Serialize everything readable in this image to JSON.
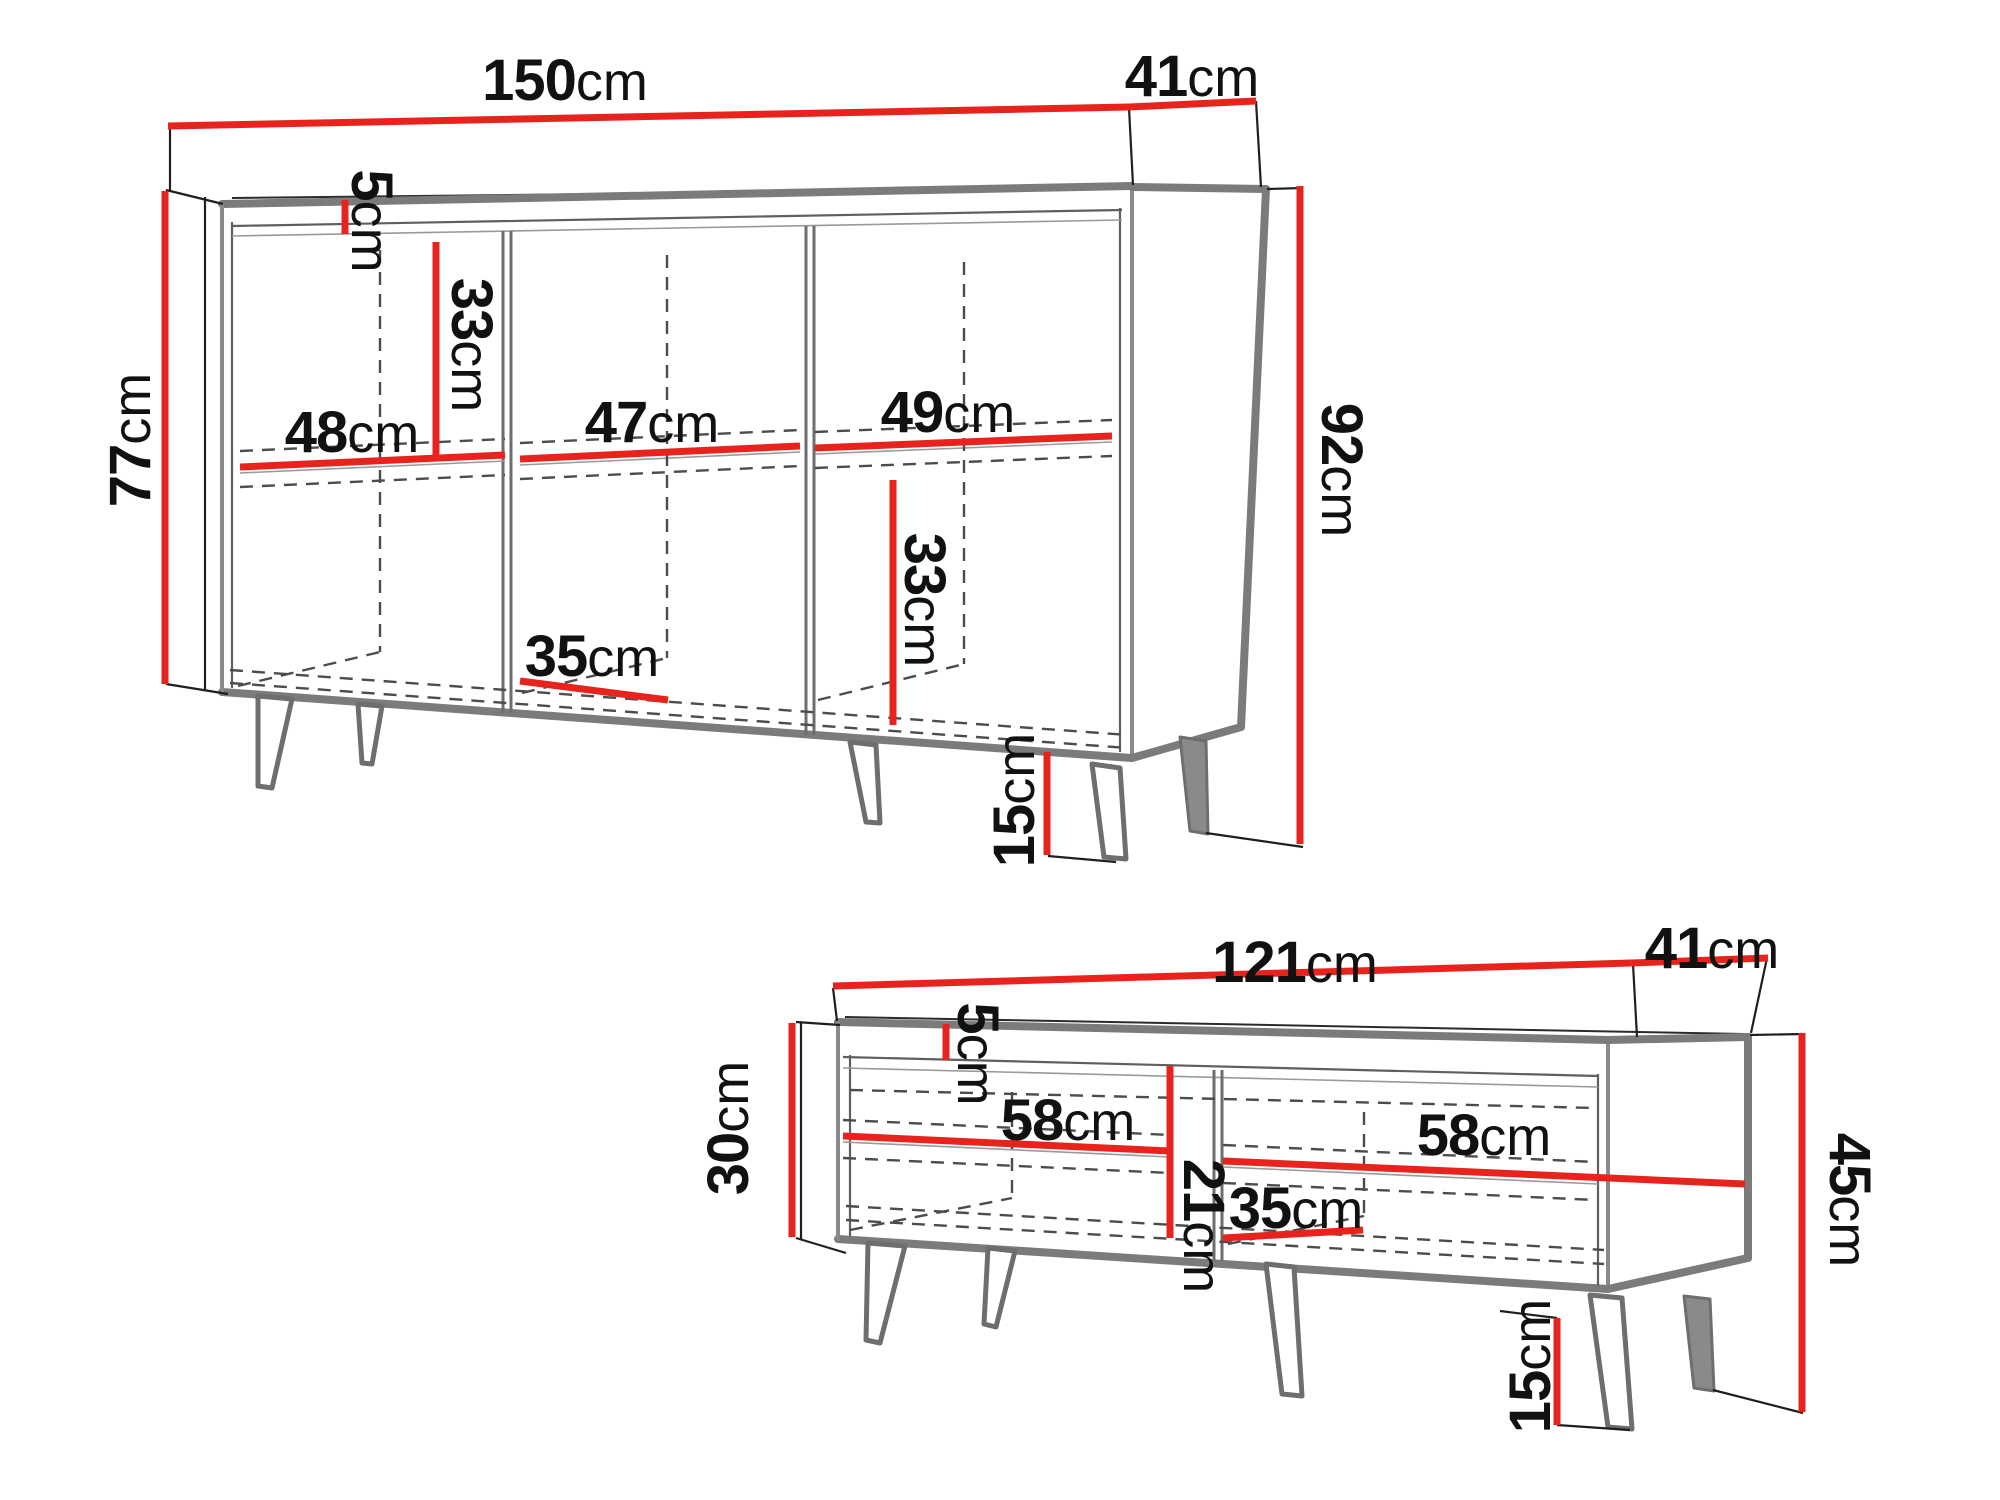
{
  "document": {
    "type": "furniture-dimension-diagram",
    "background": "#ffffff",
    "colors": {
      "dimension_line_red": "#e8231d",
      "furniture_edge_gray": "#7b7b7b",
      "extension_line_black": "#1f1f1f",
      "text_color": "#111111"
    }
  },
  "sideboard": {
    "name": "sideboard",
    "width": {
      "value": "150",
      "unit": "cm"
    },
    "depth": {
      "value": "41",
      "unit": "cm"
    },
    "body_height": {
      "value": "77",
      "unit": "cm"
    },
    "total_height": {
      "value": "92",
      "unit": "cm"
    },
    "top_gap": {
      "value": "5",
      "unit": "cm"
    },
    "upper_compartment_height": {
      "value": "33",
      "unit": "cm"
    },
    "lower_compartment_height": {
      "value": "33",
      "unit": "cm"
    },
    "left_compartment_width": {
      "value": "48",
      "unit": "cm"
    },
    "middle_compartment_width": {
      "value": "47",
      "unit": "cm"
    },
    "right_compartment_width": {
      "value": "49",
      "unit": "cm"
    },
    "inner_depth": {
      "value": "35",
      "unit": "cm"
    },
    "leg_height": {
      "value": "15",
      "unit": "cm"
    }
  },
  "tv_stand": {
    "name": "tv-stand",
    "width": {
      "value": "121",
      "unit": "cm"
    },
    "depth": {
      "value": "41",
      "unit": "cm"
    },
    "body_height": {
      "value": "30",
      "unit": "cm"
    },
    "total_height": {
      "value": "45",
      "unit": "cm"
    },
    "top_gap": {
      "value": "5",
      "unit": "cm"
    },
    "left_compartment_width": {
      "value": "58",
      "unit": "cm"
    },
    "right_compartment_width": {
      "value": "58",
      "unit": "cm"
    },
    "compartment_height": {
      "value": "21",
      "unit": "cm"
    },
    "inner_depth": {
      "value": "35",
      "unit": "cm"
    },
    "leg_height": {
      "value": "15",
      "unit": "cm"
    }
  }
}
